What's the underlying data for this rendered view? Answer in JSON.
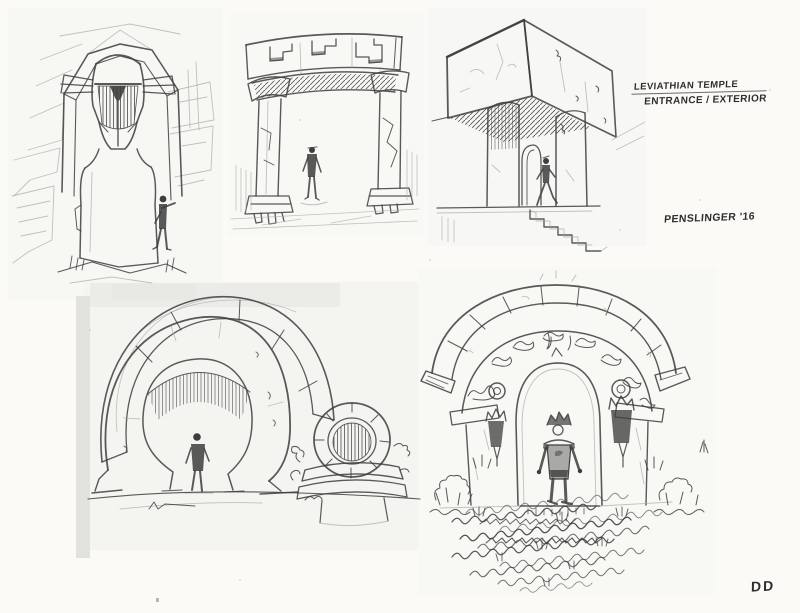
{
  "artwork": {
    "title_line1": "LEVIATHIAN TEMPLE",
    "title_line2": "ENTRANCE / EXTERIOR",
    "artist_signature": "PENSLINGER '16",
    "corner_initials": "DD",
    "sketches": [
      {
        "id": "helm-monolith",
        "label": "carved-helm-monolith-entrance"
      },
      {
        "id": "trilithon-gate",
        "label": "column-and-lintel-gate"
      },
      {
        "id": "cantilever-slab",
        "label": "cantilevered-slab-entrance-with-stairs"
      },
      {
        "id": "broken-ring-portal",
        "label": "broken-ring-portal-and-small-ring"
      },
      {
        "id": "overgrown-arch",
        "label": "overgrown-double-arch-gateway"
      }
    ]
  },
  "colors": {
    "paper": "#fbfaf7",
    "pencil": "#3d3d3d",
    "pencil_light": "#a8a8a4",
    "patch": "#efeeeb",
    "ink_text": "#2e2e2e"
  }
}
